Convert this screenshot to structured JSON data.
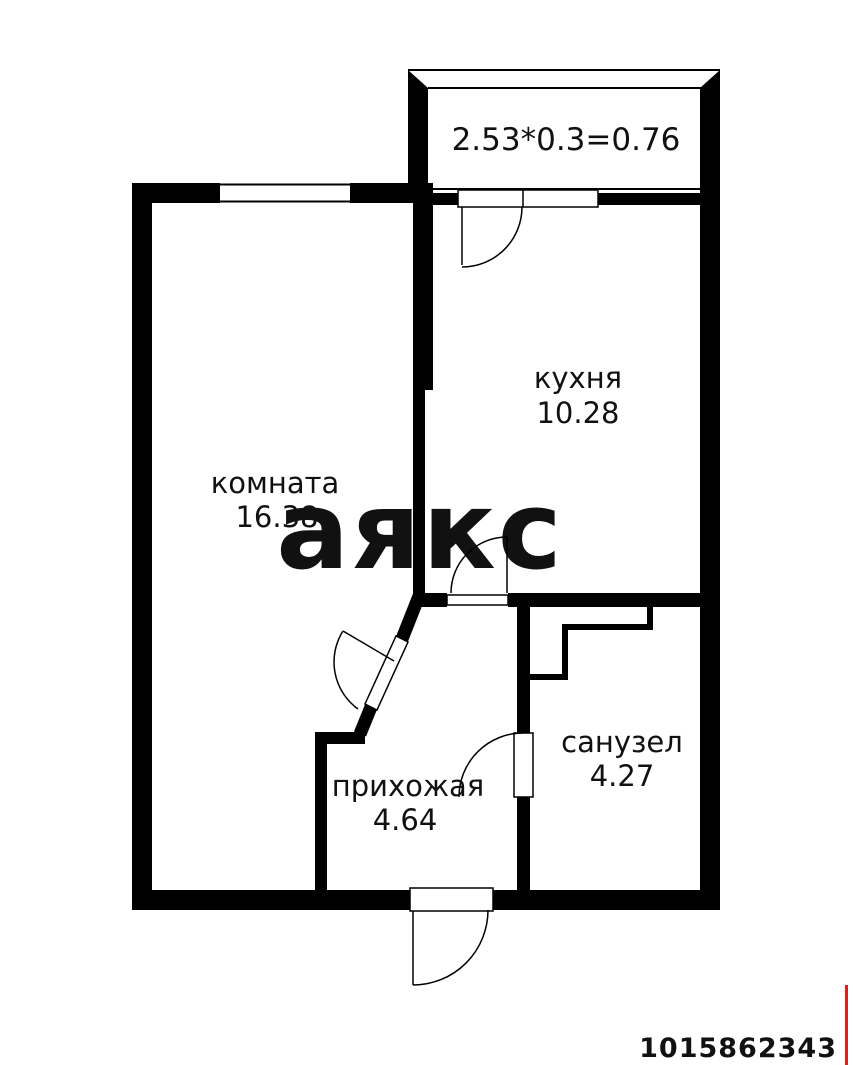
{
  "colors": {
    "background": "#ffffff",
    "walls": "#000000",
    "text": "#111111",
    "watermark": "#e3e3e3",
    "accent_red": "#d2231e"
  },
  "floorplan": {
    "balcony_formula": "2.53*0.3=0.76",
    "kitchen": {
      "label": "кухня",
      "area": "10.28"
    },
    "living_room": {
      "label": "комната",
      "area": "16.38"
    },
    "hallway": {
      "label": "прихожая",
      "area": "4.64"
    },
    "bathroom": {
      "label": "санузел",
      "area": "4.27"
    }
  },
  "watermark": {
    "text": "аякс"
  },
  "listing_id": "1015862343"
}
